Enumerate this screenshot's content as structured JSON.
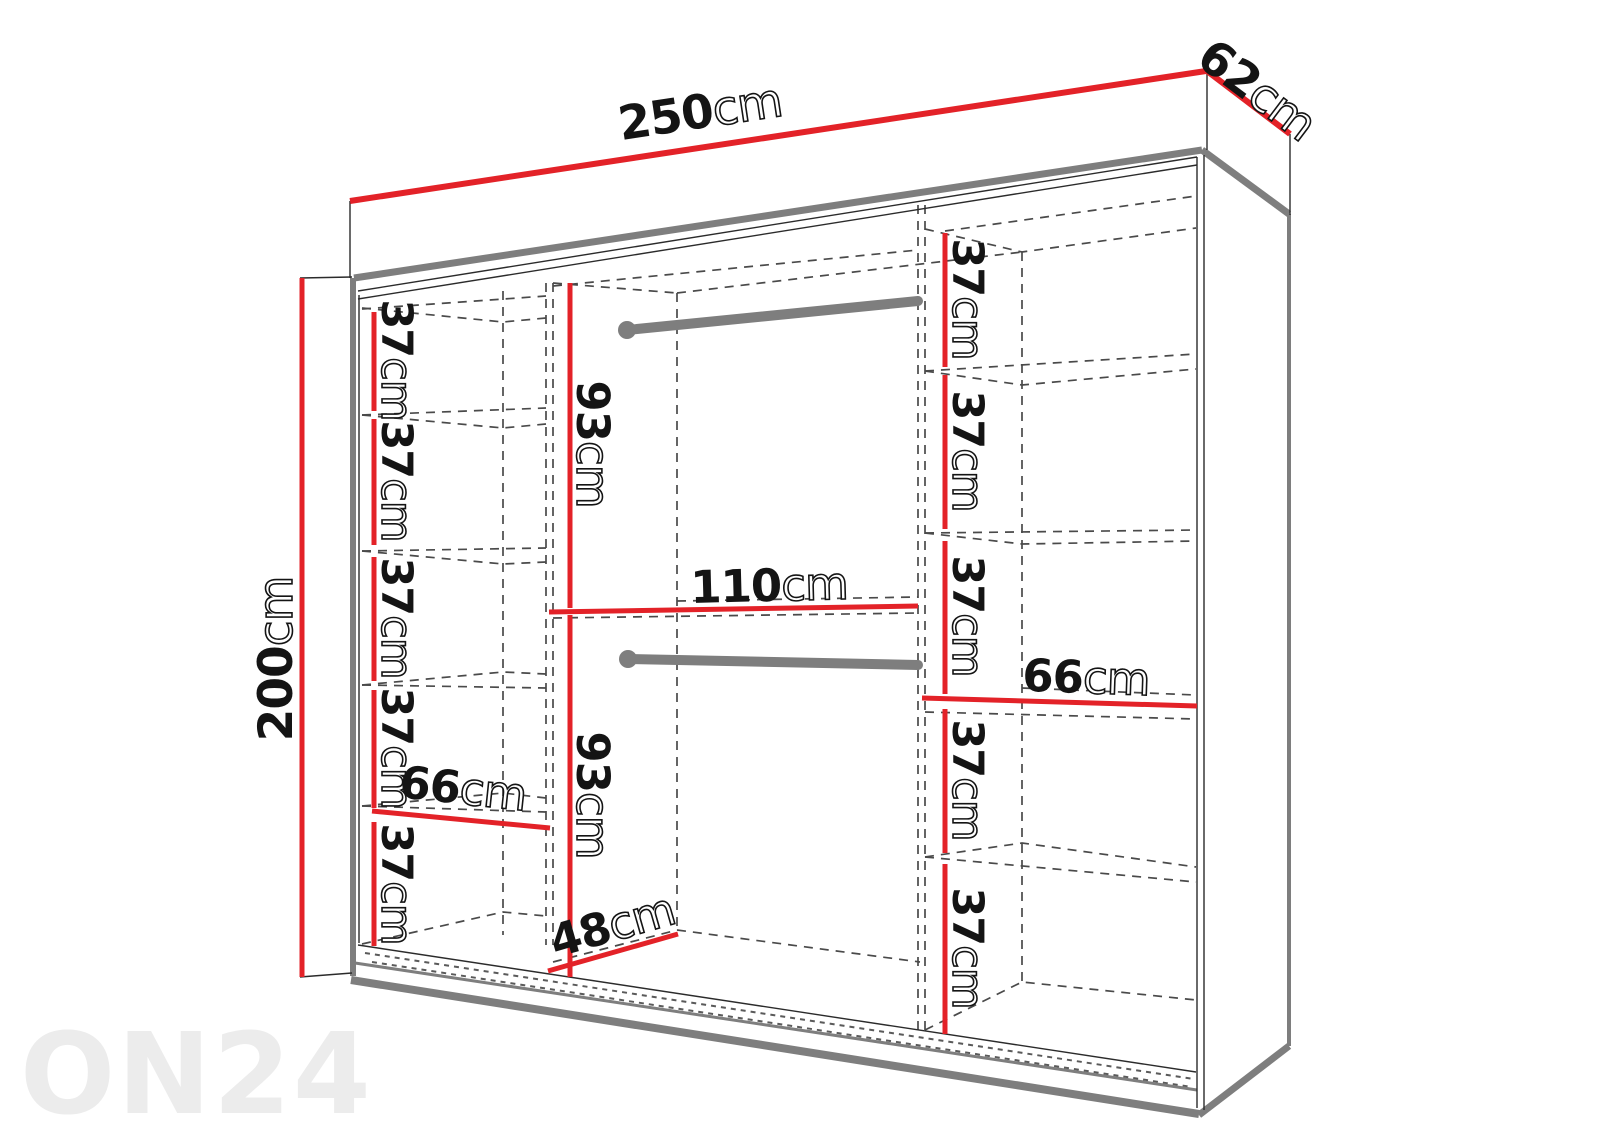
{
  "watermark": "ON24",
  "diagram": {
    "title_hint": "wardrobe dimension drawing",
    "overall": {
      "width": {
        "value": "250",
        "unit": "cm"
      },
      "depth": {
        "value": "62",
        "unit": "cm"
      },
      "height": {
        "value": "200",
        "unit": "cm"
      }
    },
    "left_column": {
      "shelves": [
        {
          "value": "37",
          "unit": "cm"
        },
        {
          "value": "37",
          "unit": "cm"
        },
        {
          "value": "37",
          "unit": "cm"
        },
        {
          "value": "37",
          "unit": "cm"
        },
        {
          "value": "37",
          "unit": "cm"
        }
      ],
      "width": {
        "value": "66",
        "unit": "cm"
      }
    },
    "middle_column": {
      "top_section_height": {
        "value": "93",
        "unit": "cm"
      },
      "width": {
        "value": "110",
        "unit": "cm"
      },
      "bottom_section_height": {
        "value": "93",
        "unit": "cm"
      },
      "interior_depth": {
        "value": "48",
        "unit": "cm"
      }
    },
    "right_column": {
      "shelves": [
        {
          "value": "37",
          "unit": "cm"
        },
        {
          "value": "37",
          "unit": "cm"
        },
        {
          "value": "37",
          "unit": "cm"
        },
        {
          "value": "37",
          "unit": "cm"
        },
        {
          "value": "37",
          "unit": "cm"
        }
      ],
      "width": {
        "value": "66",
        "unit": "cm"
      }
    },
    "colors": {
      "dimension_red": "#e32228",
      "structure_gray": "#7e7e7e",
      "dashed_gray": "#4a4a4a",
      "text_black": "#141414",
      "watermark_gray": "#ececec"
    }
  }
}
